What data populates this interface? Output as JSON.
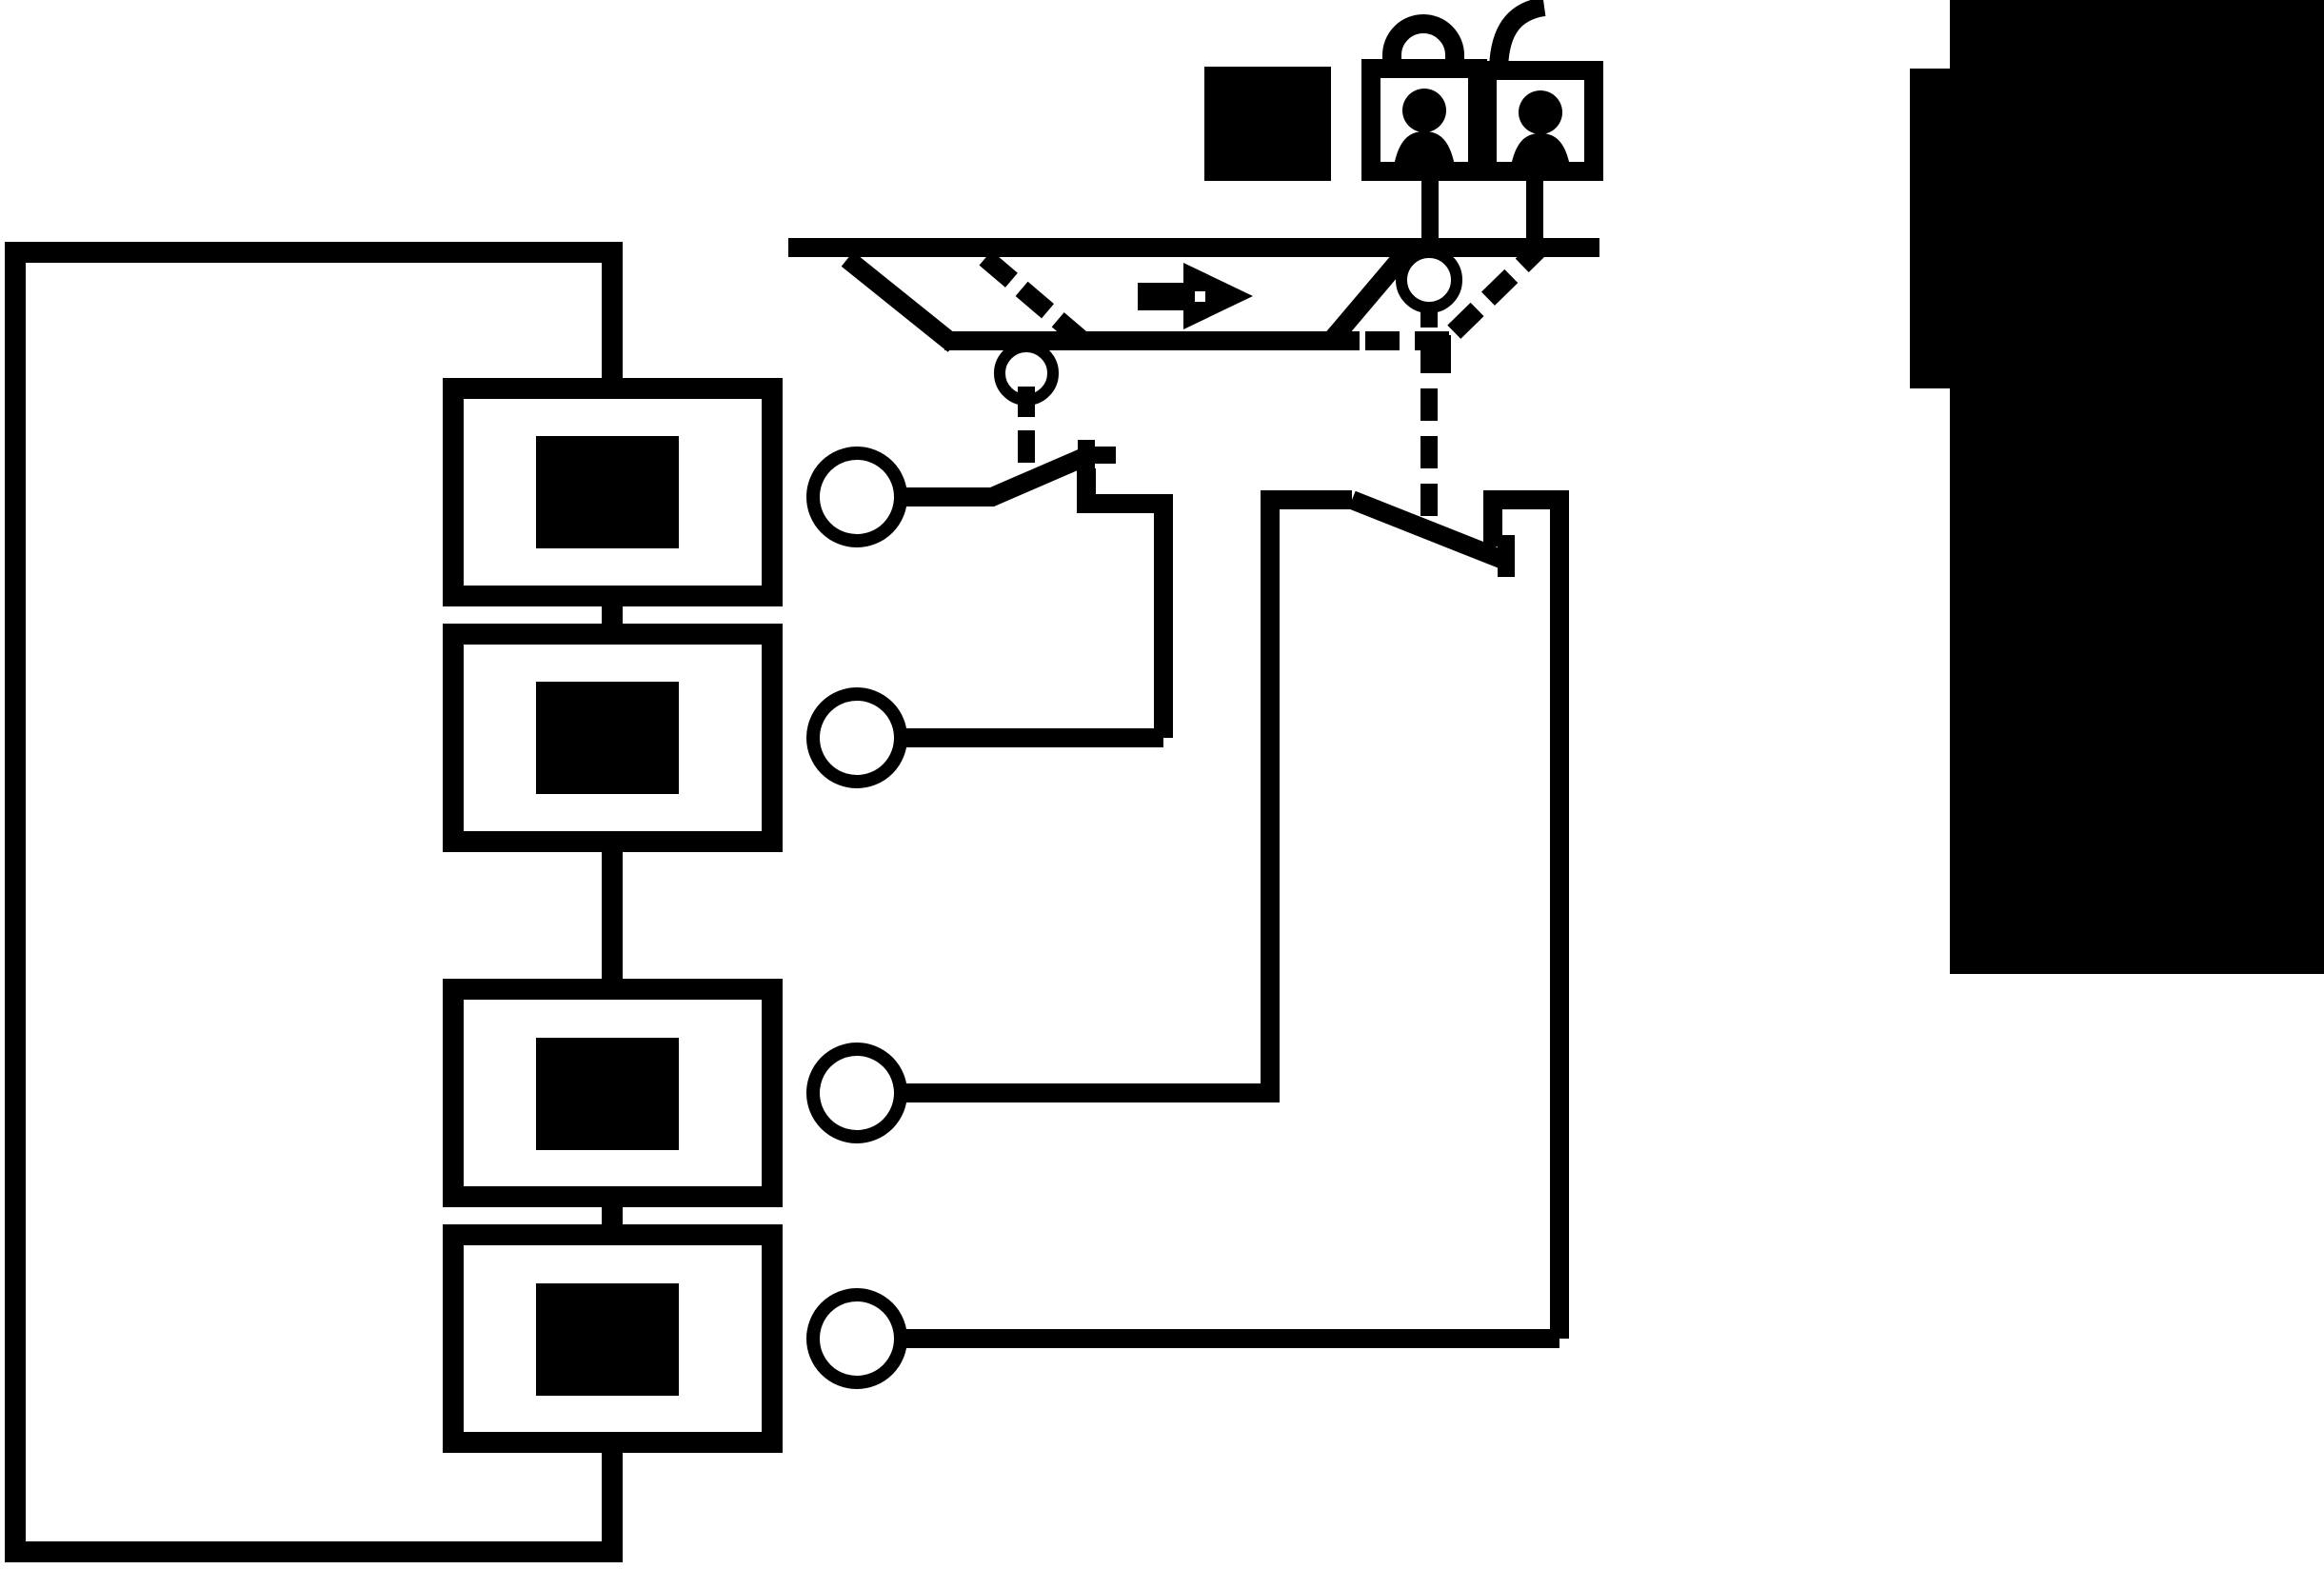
{
  "colors": {
    "ink": "#000000",
    "paper": "#ffffff"
  },
  "labels": {
    "page": "Guard interlocking safety switch schematic diagram",
    "enclosure": "Switch housing outline",
    "contact_block_1": "Contact block 1",
    "contact_block_2": "Contact block 2",
    "contact_block_3": "Contact block 3",
    "contact_block_4": "Contact block 4",
    "terminal_1": "Terminal 1",
    "terminal_2": "Terminal 2",
    "terminal_3": "Terminal 3",
    "terminal_4": "Terminal 4",
    "switch_contact_1": "Normally-open contact between terminals 1 and 2",
    "switch_contact_2": "Normally-closed contact between terminals 3 and 4",
    "guard_rail": "Guide rail",
    "guard_door": "Movable guard (closed position)",
    "guard_door_open": "Movable guard alternate open position (dashed)",
    "motion_arrow": "Guard opening direction arrow",
    "actuator_link_1": "Actuator linkage to contact 1 (dashed)",
    "actuator_link_2": "Actuator linkage to contact 2 (dashed)",
    "pivot_1": "Actuator pivot on guard",
    "pivot_2": "Actuator pivot on rail",
    "locked_padlock_person": "Locked padlock with person icon",
    "unlocked_padlock_person": "Unlocked padlock with person icon",
    "indicator_square": "Solid indicator square",
    "machine_block": "Machine / hazard zone block"
  },
  "icon_names": [
    "locked-padlock-person-icon",
    "unlocked-padlock-person-icon",
    "right-arrow-icon",
    "indicator-square-icon"
  ]
}
